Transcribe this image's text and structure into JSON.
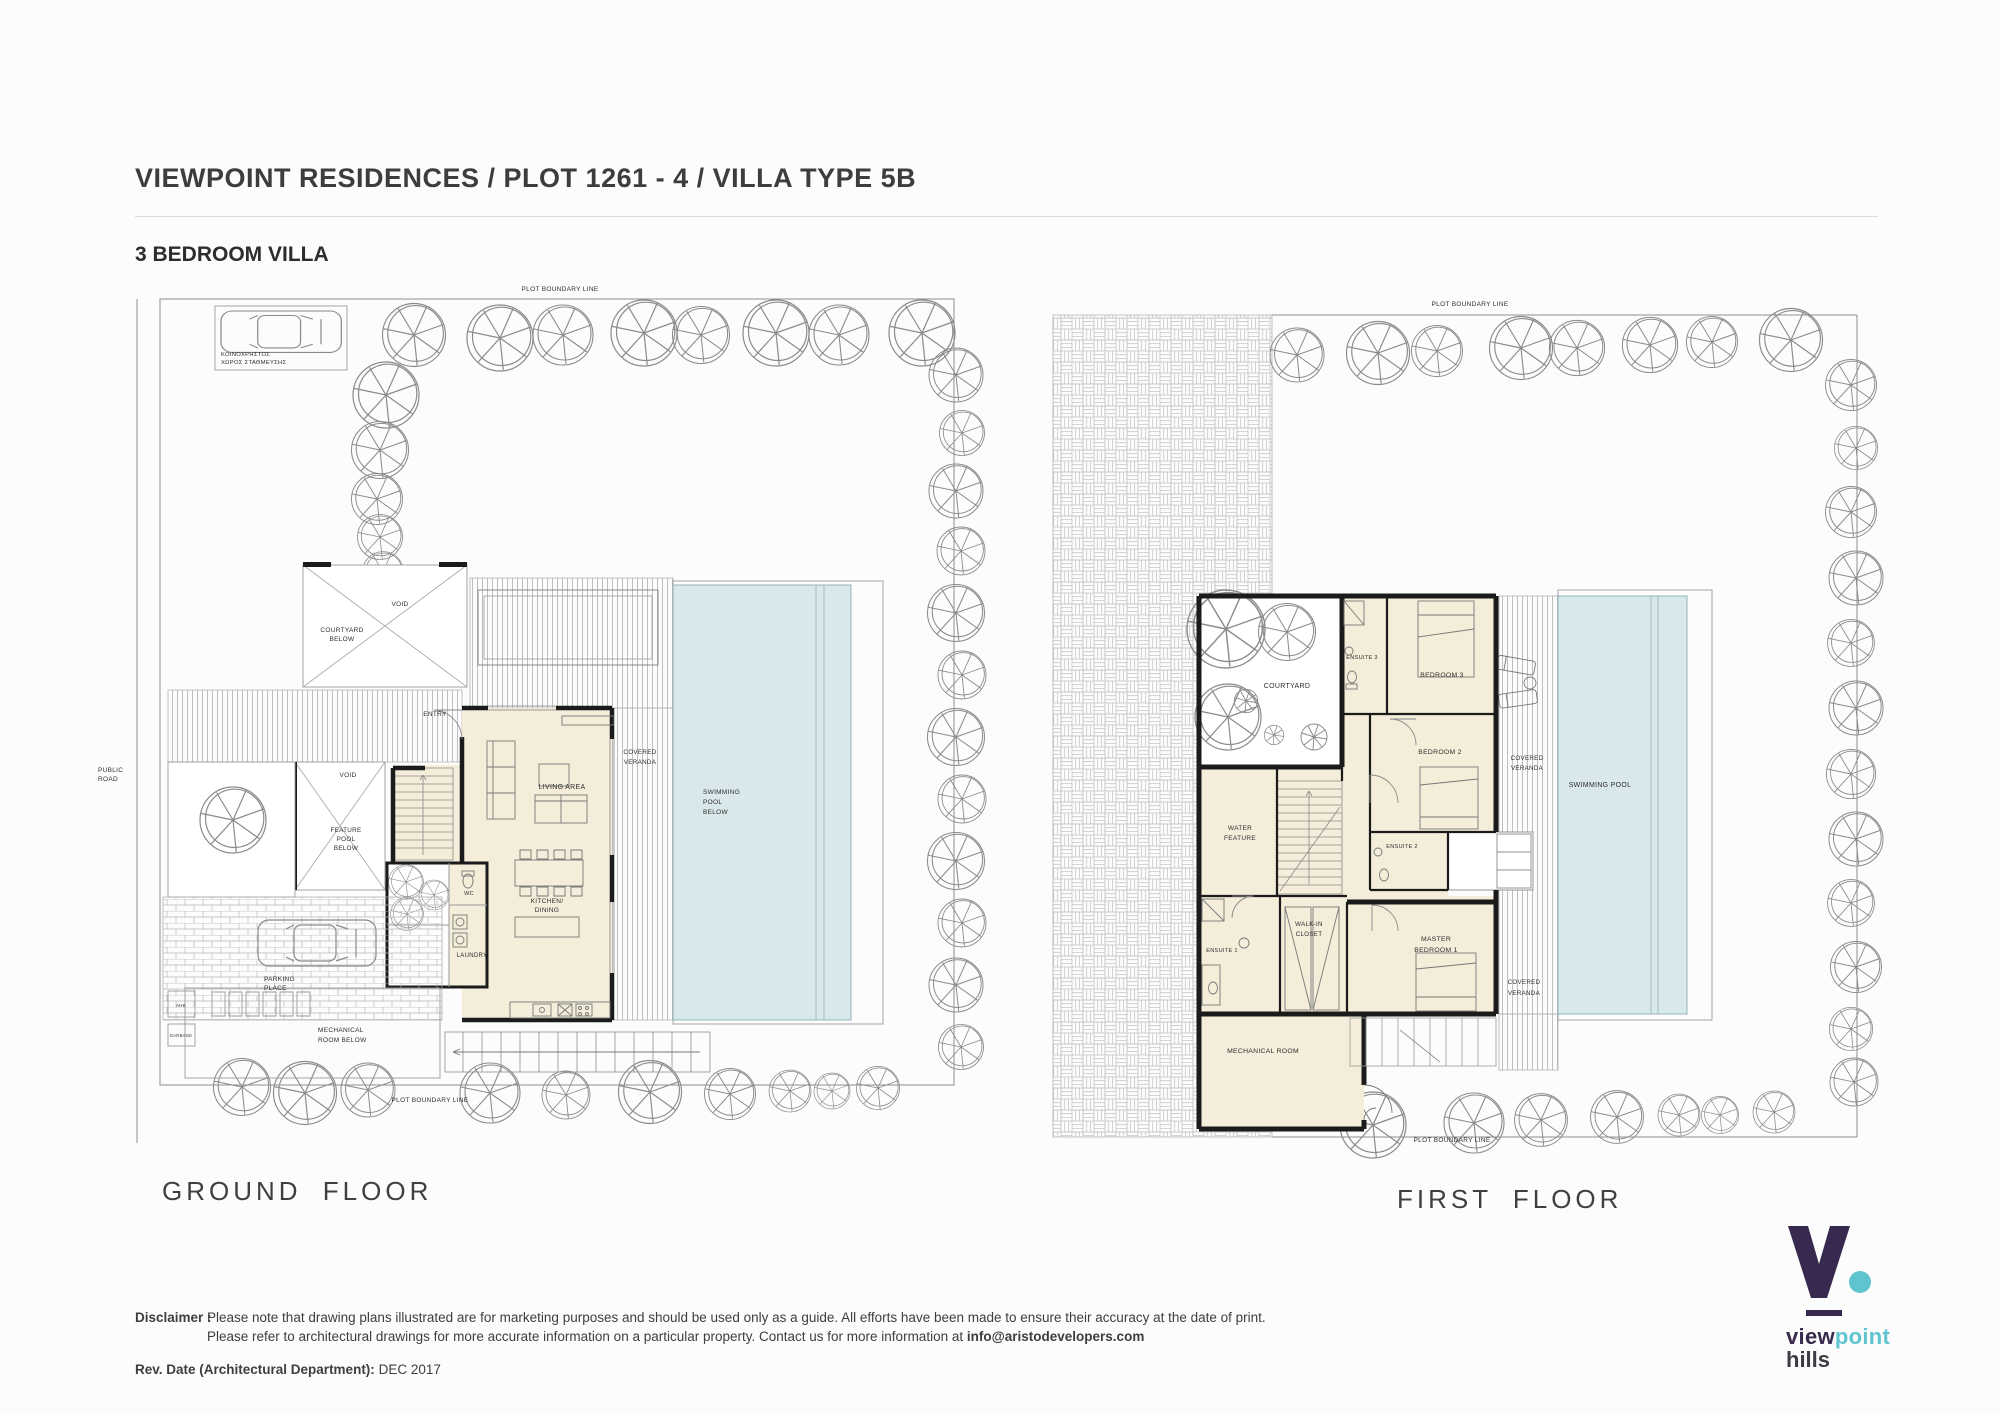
{
  "header": {
    "title": "VIEWPOINT RESIDENCES / PLOT 1261 - 4 / VILLA TYPE 5B",
    "subtitle": "3 BEDROOM VILLA"
  },
  "colors": {
    "room_fill": "#f3edd9",
    "pool_fill": "#d9e8ea",
    "wall": "#1b1b1b",
    "hatch_line": "#b0b0b0",
    "logo_purple": "#372a4e",
    "logo_teal": "#5fc4cf"
  },
  "ground_floor": {
    "title": "GROUND FLOOR",
    "labels": {
      "plot_boundary_top": "PLOT BOUNDARY LINE",
      "plot_boundary_bottom": "PLOT BOUNDARY LINE",
      "communal_parking": [
        "ΚΟΙΝΟΧΡΗΣΤΟΣ",
        "ΧΩΡΟΣ ΣΤΑΘΜΕΥΣΗΣ"
      ],
      "public_road": [
        "PUBLIC",
        "ROAD"
      ],
      "void_courtyard": "VOID",
      "courtyard_below": [
        "COURTYARD",
        "BELOW"
      ],
      "entry": "ENTRY",
      "void_feature": "VOID",
      "feature_pool_below": [
        "FEATURE",
        "POOL",
        "BELOW"
      ],
      "living_area": "LIVING AREA",
      "covered_veranda": [
        "COVERED",
        "VERANDA"
      ],
      "swimming_pool_below": [
        "SWIMMING",
        "POOL",
        "BELOW"
      ],
      "kitchen_dining": [
        "KITCHEN/",
        "DINING"
      ],
      "wc": "WC",
      "laundry": "LAUNDRY",
      "parking_place": [
        "PARKING",
        "PLACE"
      ],
      "mechanical_room_below": [
        "MECHANICAL",
        "ROOM BELOW"
      ],
      "ahk": "AHK",
      "garbage": "GARBAGE"
    }
  },
  "first_floor": {
    "title": "FIRST FLOOR",
    "labels": {
      "plot_boundary_top": "PLOT BOUNDARY LINE",
      "plot_boundary_bottom": "PLOT BOUNDARY LINE",
      "courtyard": "COURTYARD",
      "ensuite_3": "ENSUITE 3",
      "bedroom_3": "BEDROOM 3",
      "bedroom_2": "BEDROOM 2",
      "covered_veranda_mid": [
        "COVERED",
        "VERANDA"
      ],
      "swimming_pool": "SWIMMING POOL",
      "water_feature": [
        "WATER",
        "FEATURE"
      ],
      "ensuite_2": "ENSUITE 2",
      "ensuite_1": "ENSUITE 1",
      "walk_in_closet": [
        "WALK-IN",
        "CLOSET"
      ],
      "master_bedroom": [
        "MASTER",
        "BEDROOM 1"
      ],
      "covered_veranda_bottom": [
        "COVERED",
        "VERANDA"
      ],
      "mechanical_room": "MECHANICAL ROOM"
    }
  },
  "footer": {
    "disclaimer_label": "Disclaimer :",
    "disclaimer_line1": "Please note that drawing plans illustrated are for marketing purposes and should be used only as a guide. All efforts have been made to ensure their accuracy at the date of print.",
    "disclaimer_line2": "Please refer to architectural drawings for more accurate information on a particular property. Contact us for more information at",
    "disclaimer_email": "info@aristodevelopers.com",
    "rev_label": "Rev. Date (Architectural Department):",
    "rev_value": "DEC 2017"
  },
  "logo": {
    "word_view": "view",
    "word_point": "point",
    "word_hills": "hills"
  }
}
